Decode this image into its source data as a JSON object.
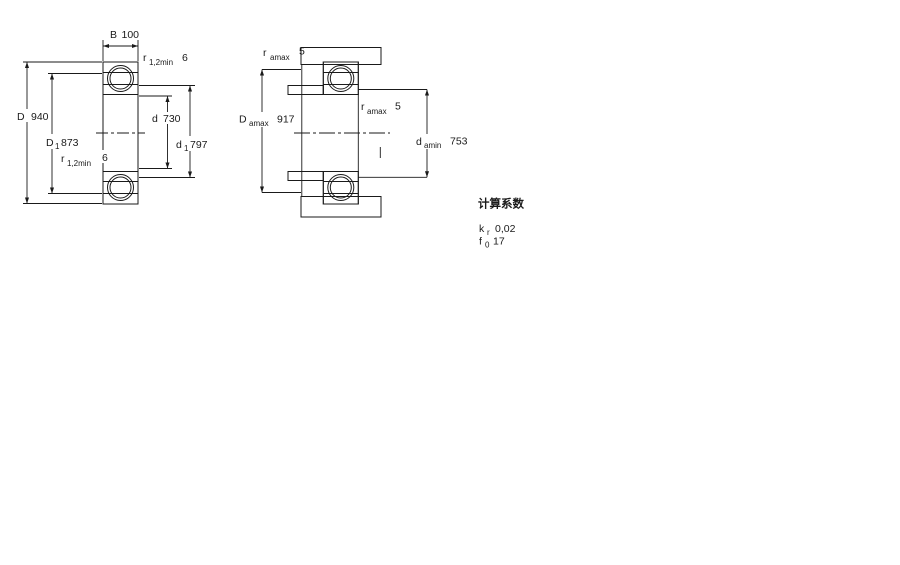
{
  "diagram1": {
    "name": "bearing cross-section with boundary dimensions",
    "dim_B": {
      "symbol": "B",
      "value": "100"
    },
    "dim_r_top": {
      "symbol": "r",
      "subscript": "1,2min",
      "value": "6"
    },
    "dim_D": {
      "symbol": "D",
      "value": "940"
    },
    "dim_D1": {
      "symbol": "D",
      "subscript": "1",
      "value": "873"
    },
    "dim_d": {
      "symbol": "d",
      "value": "730"
    },
    "dim_d1": {
      "symbol": "d",
      "subscript": "1",
      "value": "797"
    },
    "dim_r_mid": {
      "symbol": "r",
      "subscript": "1,2min",
      "value": "6"
    }
  },
  "diagram2": {
    "name": "mounted bearing with abutment dimensions",
    "dim_ra_top": {
      "symbol": "r",
      "subscript": "amax",
      "value": "5"
    },
    "dim_Damax": {
      "symbol": "D",
      "subscript": "amax",
      "value": "917"
    },
    "dim_ra_mid": {
      "symbol": "r",
      "subscript": "amax",
      "value": "5"
    },
    "dim_damin": {
      "symbol": "d",
      "subscript": "amin",
      "value": "753"
    }
  },
  "calculation_factors": {
    "title": "计算系数",
    "kr": {
      "symbol": "k",
      "subscript": "r",
      "value": "0,02"
    },
    "f0": {
      "symbol": "f",
      "subscript": "0",
      "value": "17"
    }
  },
  "colors": {
    "ring_fill": "#b3c9da",
    "ring_dot": "#7fa3bd",
    "line": "#1a1a1a"
  }
}
